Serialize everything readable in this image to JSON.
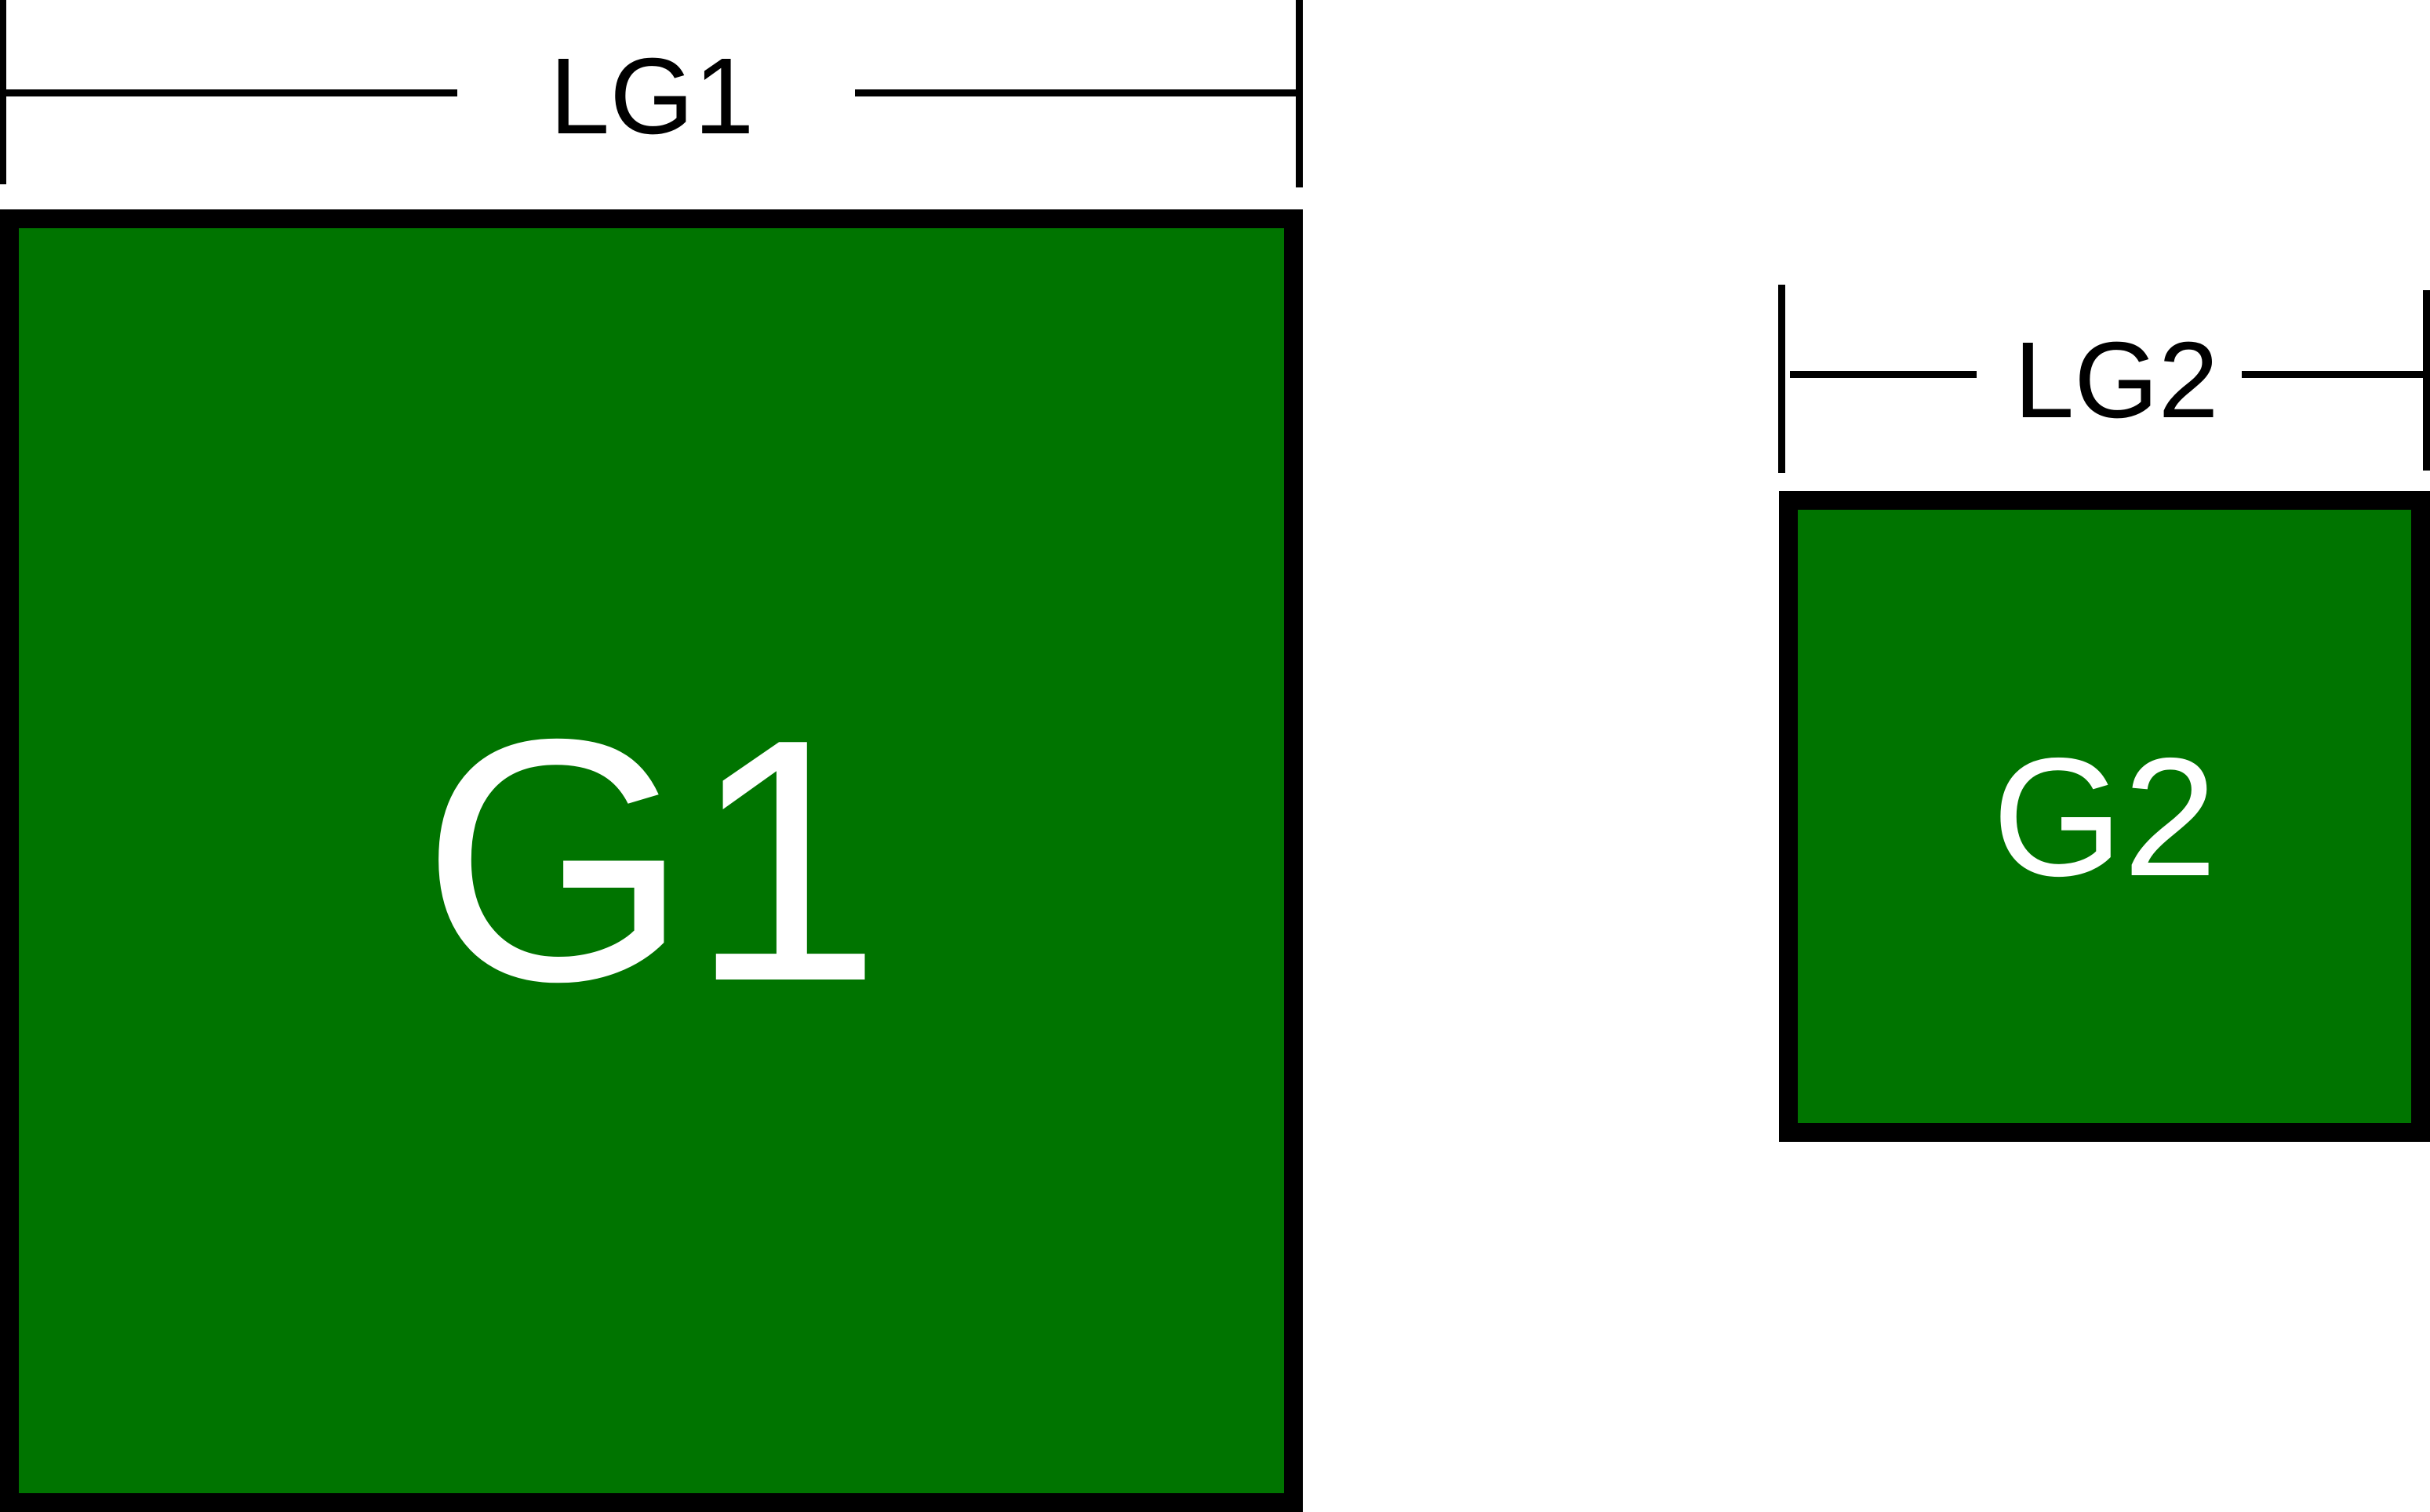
{
  "figure": {
    "colors": {
      "background": "#ffffff",
      "square_fill": "#007400",
      "square_border": "#000000",
      "line_color": "#000000",
      "square_label_color": "#ffffff",
      "dimension_label_color": "#000000"
    },
    "g1": {
      "label": "G1",
      "dimension_label": "LG1"
    },
    "g2": {
      "label": "G2",
      "dimension_label": "LG2"
    }
  }
}
